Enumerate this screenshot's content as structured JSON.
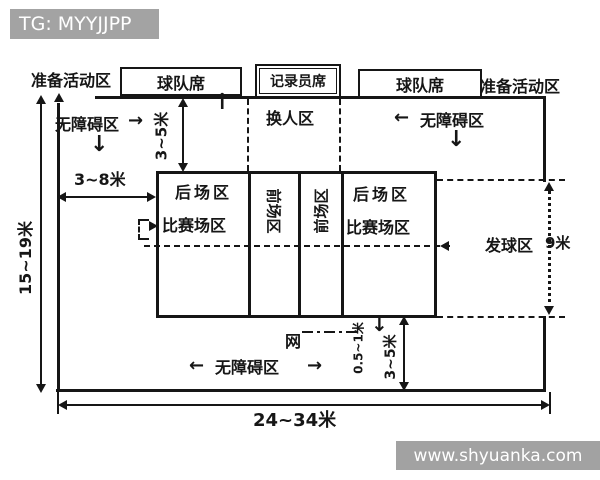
{
  "titlebar": {
    "text": "TG: MYYJJPP"
  },
  "watermark": {
    "text": "www.shyuanka.com"
  },
  "colors": {
    "ink": "#161616",
    "titlebar_bg": "#a3a3a3",
    "watermark_bg": "#989898",
    "paper": "#ffffff"
  },
  "top_row": {
    "warmup_left": "准备活动区",
    "bench_left": "球队席",
    "scorer": "记录员席",
    "bench_right": "球队席",
    "warmup_right": "准备活动区"
  },
  "zones": {
    "free_zone_left": "无障碍区",
    "free_zone_right": "无障碍区",
    "free_zone_bottom": "无障碍区",
    "substitution": "换人区",
    "back_left": "后场区",
    "playing_left": "比赛场区",
    "front_left": "前场区",
    "front_right": "前场区",
    "back_right": "后场区",
    "playing_right": "比赛场区",
    "service": "发球区",
    "net": "网"
  },
  "dimensions": {
    "total_width": "15~19米",
    "side_free_zone": "3~8米",
    "top_free_zone": "3~5米",
    "bottom_free_zone": "3~5米",
    "net_overhang": "0.5~1米",
    "service_depth": "9米",
    "total_length": "24~34米"
  },
  "glyphs": {
    "left": "←",
    "right": "→",
    "up": "↑",
    "down": "↓"
  }
}
